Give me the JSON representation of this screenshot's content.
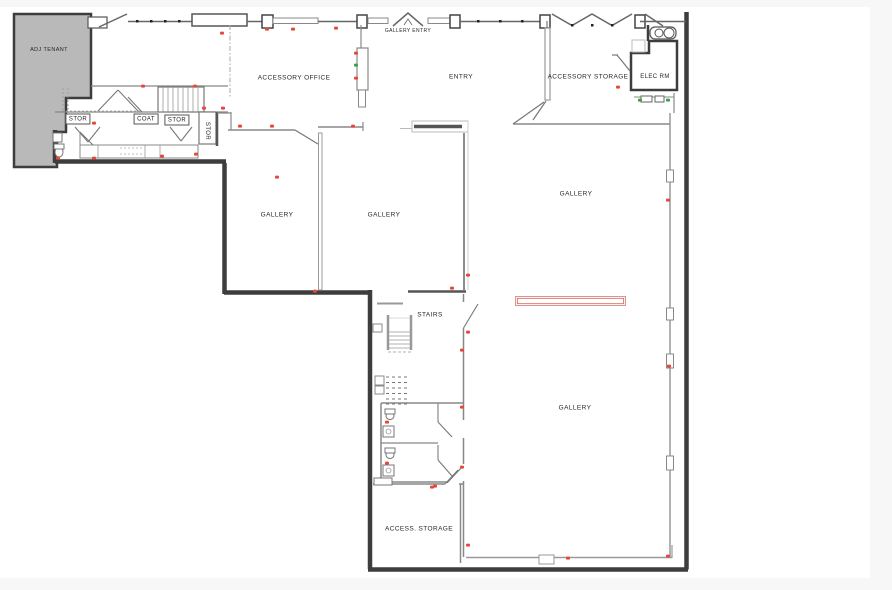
{
  "page": {
    "background": "#ffffff",
    "margin_color": "#f7f7f7"
  },
  "colors": {
    "wall_dark": "#3d3d3d",
    "wall_light": "#8a8a8a",
    "adj_tenant_fill": "#b9b9b9",
    "marker_red": "#e8473b",
    "marker_green": "#3da04a",
    "new_wall_red": "#d96a60"
  },
  "rooms": [
    {
      "id": "adj-tenant",
      "label": "ADJ TENANT",
      "x": 49,
      "y": 50,
      "size": 5.5
    },
    {
      "id": "accessory-office",
      "label": "ACCESSORY OFFICE",
      "x": 294,
      "y": 78
    },
    {
      "id": "gallery-entry",
      "label": "GALLERY ENTRY",
      "x": 408,
      "y": 31,
      "size": 5
    },
    {
      "id": "entry",
      "label": "ENTRY",
      "x": 461,
      "y": 77
    },
    {
      "id": "accessory-storage",
      "label": "ACCESSORY STORAGE",
      "x": 588,
      "y": 77
    },
    {
      "id": "elec-rm",
      "label": "ELEC RM",
      "x": 655,
      "y": 77,
      "size": 6
    },
    {
      "id": "stor-1",
      "label": "STOR",
      "x": 78,
      "y": 119,
      "size": 6,
      "boxed": true
    },
    {
      "id": "coat",
      "label": "COAT",
      "x": 146,
      "y": 119,
      "size": 6,
      "boxed": true
    },
    {
      "id": "stor-2",
      "label": "STOR",
      "x": 177,
      "y": 120,
      "size": 6,
      "boxed": true
    },
    {
      "id": "stor-3",
      "label": "STOR",
      "x": 207,
      "y": 131,
      "size": 6,
      "rotated": true
    },
    {
      "id": "gallery-1",
      "label": "GALLERY",
      "x": 277,
      "y": 215
    },
    {
      "id": "gallery-2",
      "label": "GALLERY",
      "x": 384,
      "y": 215
    },
    {
      "id": "gallery-3",
      "label": "GALLERY",
      "x": 576,
      "y": 194
    },
    {
      "id": "gallery-4",
      "label": "GALLERY",
      "x": 575,
      "y": 408
    },
    {
      "id": "stairs",
      "label": "STAIRS",
      "x": 430,
      "y": 315
    },
    {
      "id": "access-storage",
      "label": "ACCESS. STORAGE",
      "x": 419,
      "y": 529
    }
  ],
  "annotations": {
    "red_markers": [
      [
        222,
        33
      ],
      [
        267,
        29
      ],
      [
        293,
        29
      ],
      [
        336,
        28
      ],
      [
        356,
        53
      ],
      [
        356,
        78
      ],
      [
        143,
        86
      ],
      [
        195,
        86
      ],
      [
        94,
        123
      ],
      [
        58,
        158
      ],
      [
        94,
        158
      ],
      [
        162,
        156
      ],
      [
        196,
        154
      ],
      [
        204,
        108
      ],
      [
        223,
        108
      ],
      [
        240,
        126
      ],
      [
        272,
        126
      ],
      [
        277,
        177
      ],
      [
        353,
        126
      ],
      [
        315,
        291
      ],
      [
        452,
        288
      ],
      [
        468,
        275
      ],
      [
        668,
        200
      ],
      [
        669,
        366
      ],
      [
        468,
        332
      ],
      [
        462,
        350
      ],
      [
        462,
        407
      ],
      [
        462,
        467
      ],
      [
        435,
        486
      ],
      [
        387,
        422
      ],
      [
        387,
        463
      ],
      [
        432,
        487
      ],
      [
        618,
        87
      ],
      [
        468,
        545
      ],
      [
        568,
        558
      ],
      [
        668,
        556
      ]
    ],
    "green_markers": [
      [
        356,
        65
      ],
      [
        640,
        100
      ],
      [
        668,
        100
      ]
    ],
    "new_partition": {
      "x": 515,
      "y": 296,
      "width": 109,
      "height": 8
    }
  }
}
